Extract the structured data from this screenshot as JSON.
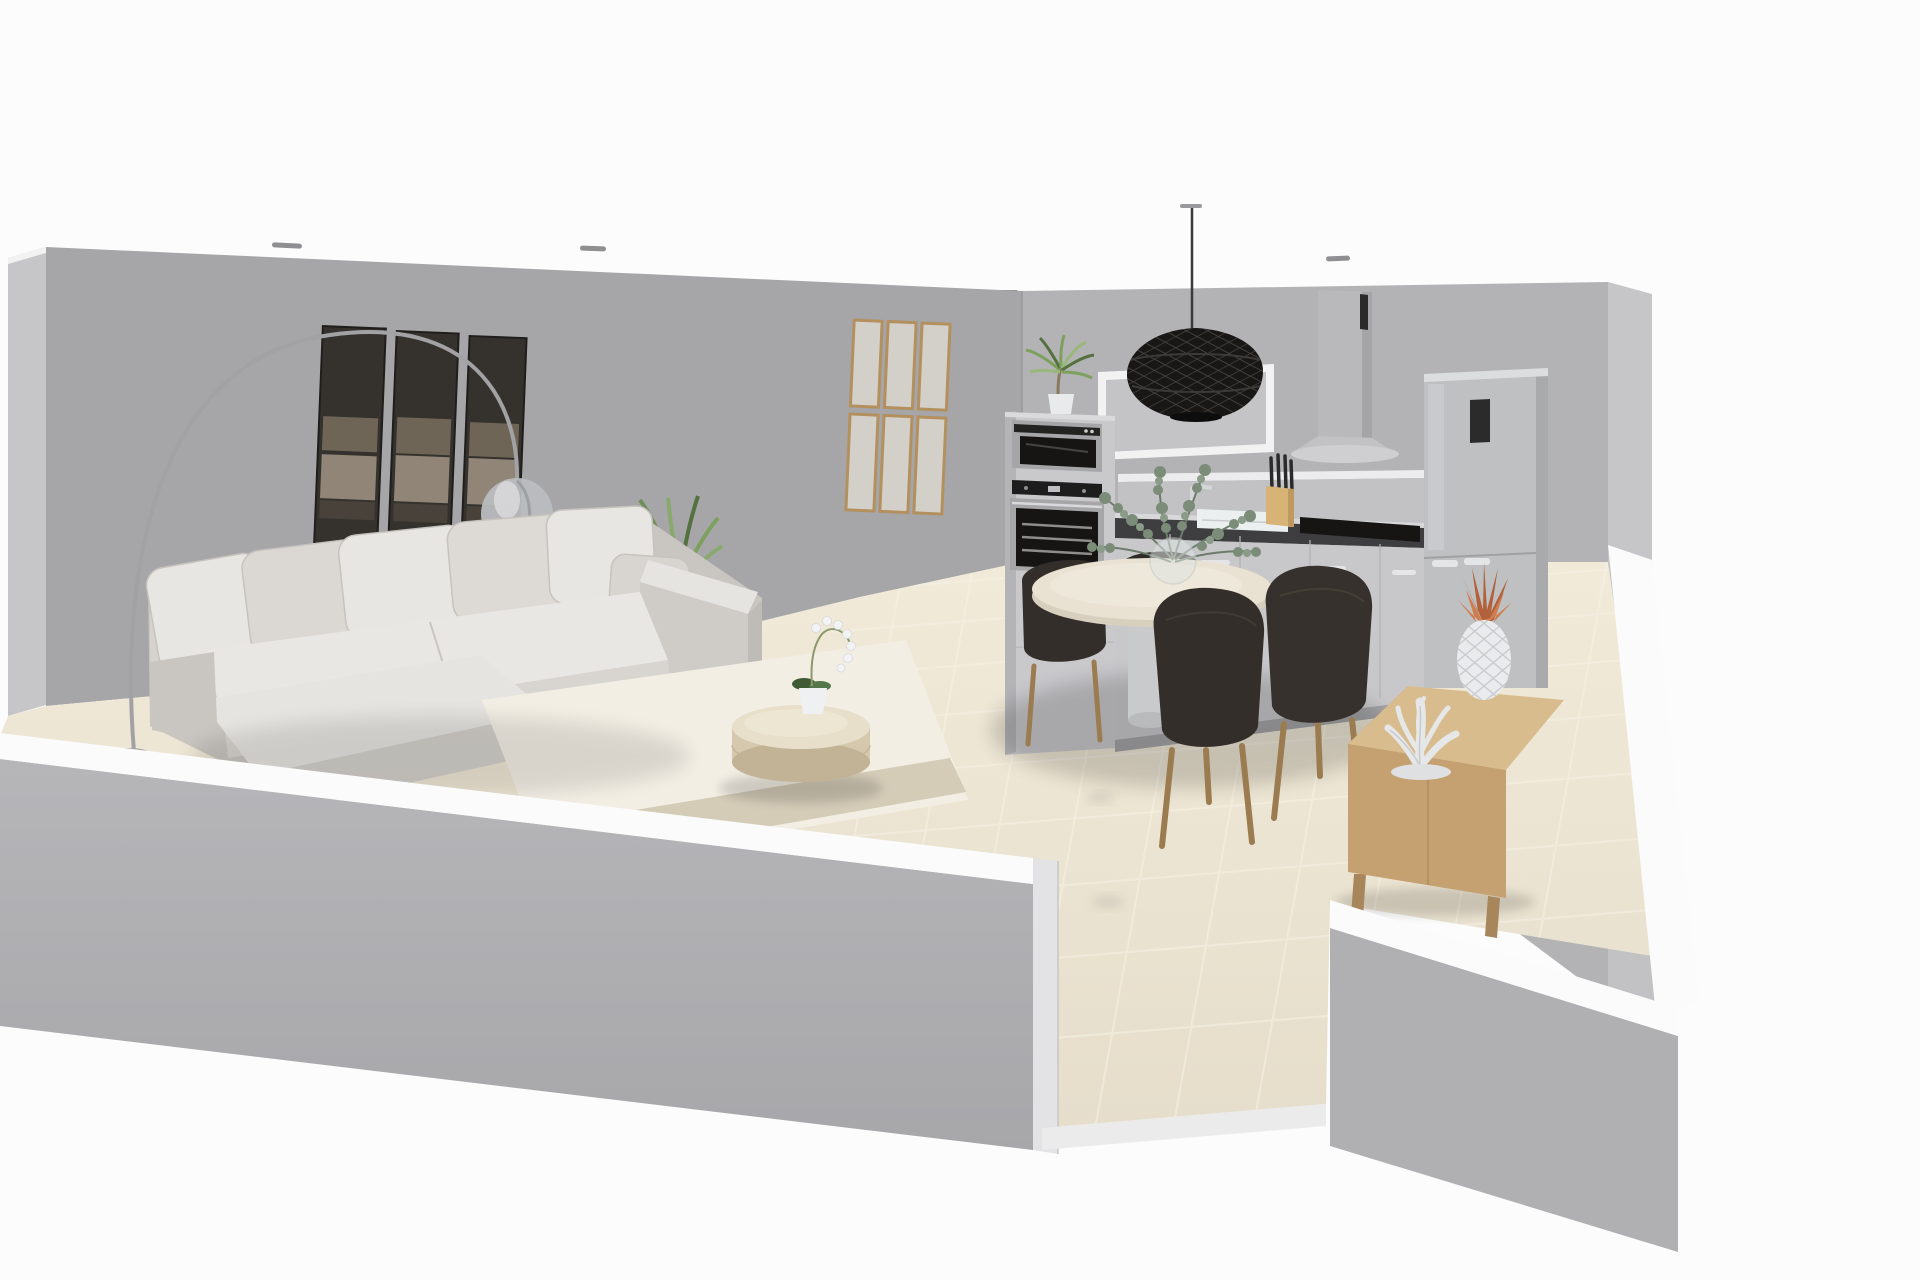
{
  "meta": {
    "type": "3d-interior-render",
    "view": "cutaway perspective of an open-plan apartment",
    "canvas_width": 1920,
    "canvas_height": 1280
  },
  "palette": {
    "background": "#fcfcfc",
    "wall_west": "#a6a6a9",
    "wall_north": "#b3b3b6",
    "wall_edge": "#c6c6c9",
    "wall_inner_right": "#c2c2c5",
    "wall_front": "#b0b0b3",
    "wall_cap": "#fbfbfb",
    "wall_cut_face": "#e3e3e5",
    "floor_light": "#f0e9da",
    "floor_dark": "#e5ddca",
    "grout": "#f6f1e4",
    "slab_edge": "#ebebec",
    "rug": "#f3eee4",
    "rug_band": "#cfc5b0",
    "sofa_light": "#e8e6e2",
    "sofa_mid": "#d6d3cf",
    "sofa_dark": "#c9c6c1",
    "art_dark": "#35322e",
    "art_mid": "#756a5c",
    "art_light": "#a89a88",
    "frame_wood": "#b3905e",
    "frame_paper": "#d3d0ca",
    "lamp_metal": "#a2a2a5",
    "lamp_glass": "#bbbcbf",
    "plant_green": "#7da05e",
    "plant_dark": "#55713f",
    "foliage": "#7b8c79",
    "foliage_dark": "#66766</1>5",
    "table_top": "#e8dfca",
    "table_side": "#d6c8ad",
    "orchid_white": "#f2f3f5",
    "cabinet": "#c8c8cb",
    "cabinet_tall": "#c9c9cc",
    "counter_dark": "#3e3e40",
    "steel": "#a6a6a9",
    "appliance_glass": "#161514",
    "fridge": "#bec0c2",
    "pendant_black": "#181716",
    "dining_top": "#e9e1d2",
    "dining_rim": "#d8d0bf",
    "pedestal": "#c9cacc",
    "chair_dark": "#332e29",
    "chair_leg": "#9b7b50",
    "sideboard_top": "#d9bc8e",
    "sideboard_front": "#c5a172",
    "sideboard_side": "#b5916a",
    "pineapple_white": "#eaebed",
    "pineapple_leaf": "#b2613a",
    "coral_white": "#e6e7e9",
    "knife_block": "#d7b377",
    "spotlight": "#8f8f92"
  },
  "objects": {
    "scene": "Open plan living room, dining area and kitchen - 3D cutaway render",
    "left_wall": "left wall, cut away",
    "back_wall": "living room back wall",
    "kitchen_wall": "kitchen back wall",
    "right_wall": "right wall, cut away",
    "front_wall_left": "front wall left section, cut away",
    "front_wall_right": "front wall right section, cut away",
    "doorway": "doorway opening in front wall",
    "floor": "beige tiled floor",
    "rug": "area rug",
    "ceiling_spotlights": "recessed ceiling spotlights",
    "wall_art": "three panel abstract wall art",
    "frame_grid": "grid of six wooden wall frames",
    "arc_lamp": "arc floor lamp with glass globe shade",
    "sofa": "light grey sectional sofa with chaise",
    "yucca_plant": "green plant behind sofa",
    "coffee_table": "round drum coffee table",
    "orchid": "white potted orchid on coffee table",
    "oven_column": "tall cabinet with built-in ovens",
    "microwave": "built-in compact oven",
    "oven": "built-in oven",
    "cabinet_plant": "potted plant on top of oven cabinet",
    "range_hood": "wall mounted range hood",
    "wall_panel": "white framed wall panel",
    "pendant_lamp": "black woven pendant lamp",
    "counter": "kitchen base cabinets with dark worktop",
    "sink": "kitchen sink with faucet",
    "hob": "black cooktop",
    "knife_block": "knife block with knives",
    "fridge": "free standing fridge freezer",
    "dining_table": "round pedestal dining table",
    "dining_chairs": "dark upholstered dining chairs",
    "vase": "glass vase with eucalyptus branches",
    "sideboard": "light wood sideboard",
    "pineapple": "ceramic pineapple ornament with copper leaves",
    "coral": "white coral ornament"
  },
  "counts": {
    "ceiling_spotlights": 5,
    "art_panels": 3,
    "wall_frames": 6,
    "sofa_pillows": 6,
    "dining_chairs": 4,
    "pendant_lamps": 1
  }
}
